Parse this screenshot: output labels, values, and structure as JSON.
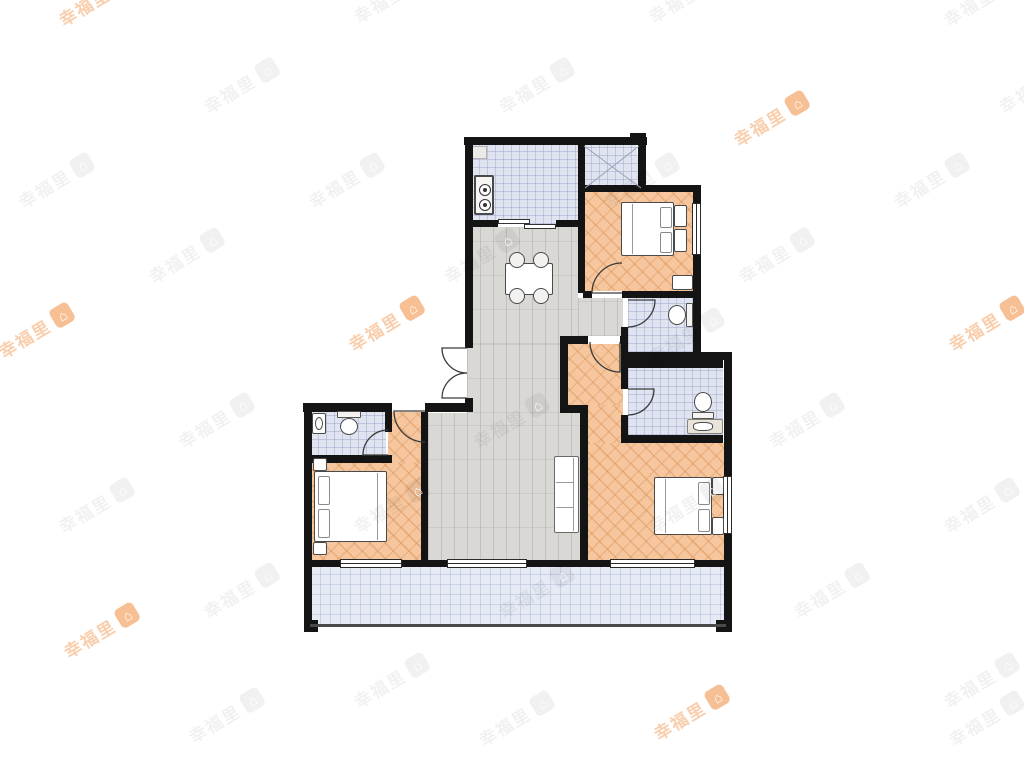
{
  "watermark": {
    "text": "幸福里",
    "logo_glyph": "⌂",
    "orange_color": "#f08a3c",
    "gray_color": "#000000",
    "positions": [
      {
        "x": 60,
        "y": 8,
        "c": "o"
      },
      {
        "x": 355,
        "y": 5,
        "c": "g"
      },
      {
        "x": 650,
        "y": 5,
        "c": "g"
      },
      {
        "x": 945,
        "y": 8,
        "c": "g"
      },
      {
        "x": 205,
        "y": 95,
        "c": "g"
      },
      {
        "x": 500,
        "y": 95,
        "c": "g"
      },
      {
        "x": 1000,
        "y": 95,
        "c": "g"
      },
      {
        "x": 735,
        "y": 128,
        "c": "o"
      },
      {
        "x": 20,
        "y": 190,
        "c": "g"
      },
      {
        "x": 310,
        "y": 190,
        "c": "g"
      },
      {
        "x": 605,
        "y": 190,
        "c": "g"
      },
      {
        "x": 895,
        "y": 190,
        "c": "g"
      },
      {
        "x": 150,
        "y": 265,
        "c": "g"
      },
      {
        "x": 445,
        "y": 265,
        "c": "g"
      },
      {
        "x": 740,
        "y": 265,
        "c": "g"
      },
      {
        "x": 0,
        "y": 340,
        "c": "o"
      },
      {
        "x": 350,
        "y": 333,
        "c": "o"
      },
      {
        "x": 650,
        "y": 345,
        "c": "g"
      },
      {
        "x": 950,
        "y": 333,
        "c": "o"
      },
      {
        "x": 180,
        "y": 430,
        "c": "g"
      },
      {
        "x": 475,
        "y": 430,
        "c": "g"
      },
      {
        "x": 770,
        "y": 430,
        "c": "g"
      },
      {
        "x": 60,
        "y": 515,
        "c": "g"
      },
      {
        "x": 355,
        "y": 515,
        "c": "g"
      },
      {
        "x": 650,
        "y": 515,
        "c": "g"
      },
      {
        "x": 945,
        "y": 515,
        "c": "g"
      },
      {
        "x": 205,
        "y": 600,
        "c": "g"
      },
      {
        "x": 500,
        "y": 600,
        "c": "g"
      },
      {
        "x": 795,
        "y": 600,
        "c": "g"
      },
      {
        "x": 65,
        "y": 640,
        "c": "o"
      },
      {
        "x": 355,
        "y": 690,
        "c": "g"
      },
      {
        "x": 945,
        "y": 690,
        "c": "g"
      },
      {
        "x": 190,
        "y": 725,
        "c": "g"
      },
      {
        "x": 480,
        "y": 728,
        "c": "g"
      },
      {
        "x": 655,
        "y": 722,
        "c": "o"
      },
      {
        "x": 950,
        "y": 728,
        "c": "g"
      }
    ]
  },
  "palette": {
    "wall": "#141414",
    "wood_floor": "#f6c79e",
    "gray_floor": "#d9d8d5",
    "tile_floor": "#e0e4f1",
    "balcony_floor": "#e5eaf5",
    "fixture_line": "#4a4a4a"
  },
  "floorplan": {
    "floors": [
      {
        "name": "kitchen-floor",
        "fill": "tile",
        "x": 471,
        "y": 144,
        "w": 108,
        "h": 80
      },
      {
        "name": "shaft-floor",
        "fill": "tile",
        "x": 583,
        "y": 144,
        "w": 60,
        "h": 44,
        "clip": "polygon(0 0,88% 0,100% 100%,0 100%)"
      },
      {
        "name": "bedroom-north-floor",
        "fill": "wood",
        "x": 583,
        "y": 190,
        "w": 110,
        "h": 101
      },
      {
        "name": "hall-nook-floor",
        "fill": "gray",
        "x": 578,
        "y": 298,
        "w": 45,
        "h": 38
      },
      {
        "name": "dining-floor",
        "fill": "gray",
        "x": 467,
        "y": 227,
        "w": 111,
        "h": 117
      },
      {
        "name": "dining-floor-lower",
        "fill": "gray",
        "x": 467,
        "y": 344,
        "w": 93,
        "h": 69
      },
      {
        "name": "living-floor",
        "fill": "gray",
        "x": 428,
        "y": 413,
        "w": 152,
        "h": 149
      },
      {
        "name": "master-corridor-floor",
        "fill": "wood",
        "x": 568,
        "y": 344,
        "w": 55,
        "h": 61
      },
      {
        "name": "master-corridor-floor-lower",
        "fill": "wood",
        "x": 588,
        "y": 405,
        "w": 35,
        "h": 38
      },
      {
        "name": "master-bedroom-floor",
        "fill": "wood",
        "x": 588,
        "y": 443,
        "w": 136,
        "h": 119
      },
      {
        "name": "bathroom-north-floor",
        "fill": "tile",
        "x": 628,
        "y": 298,
        "w": 65,
        "h": 54
      },
      {
        "name": "bathroom-master-floor",
        "fill": "tile",
        "x": 628,
        "y": 368,
        "w": 95,
        "h": 67
      },
      {
        "name": "bathroom-west-floor",
        "fill": "tile",
        "x": 310,
        "y": 412,
        "w": 76,
        "h": 44
      },
      {
        "name": "bedroom-west-floor",
        "fill": "wood",
        "x": 310,
        "y": 462,
        "w": 112,
        "h": 100
      },
      {
        "name": "bedroom-west-corridor-floor",
        "fill": "wood",
        "x": 388,
        "y": 412,
        "w": 34,
        "h": 51
      },
      {
        "name": "balcony-floor",
        "fill": "balcony",
        "x": 310,
        "y": 565,
        "w": 414,
        "h": 60
      },
      {
        "name": "kitchen-flue",
        "fill": "flue",
        "x": 472,
        "y": 146,
        "w": 15,
        "h": 13
      }
    ],
    "walls": [
      {
        "x": 464,
        "y": 137,
        "w": 183,
        "h": 8
      },
      {
        "x": 638,
        "y": 145,
        "w": 8,
        "h": 45
      },
      {
        "x": 630,
        "y": 133,
        "w": 16,
        "h": 12
      },
      {
        "x": 583,
        "y": 185,
        "w": 117,
        "h": 7
      },
      {
        "x": 693,
        "y": 185,
        "w": 8,
        "h": 178
      },
      {
        "x": 693,
        "y": 352,
        "w": 38,
        "h": 8
      },
      {
        "x": 724,
        "y": 352,
        "w": 8,
        "h": 280
      },
      {
        "x": 304,
        "y": 403,
        "w": 8,
        "h": 160
      },
      {
        "x": 304,
        "y": 562,
        "w": 8,
        "h": 70
      },
      {
        "x": 303,
        "y": 403,
        "w": 89,
        "h": 9
      },
      {
        "x": 425,
        "y": 403,
        "w": 48,
        "h": 9
      },
      {
        "x": 465,
        "y": 137,
        "w": 8,
        "h": 211
      },
      {
        "x": 465,
        "y": 398,
        "w": 8,
        "h": 14
      },
      {
        "x": 465,
        "y": 220,
        "w": 33,
        "h": 7
      },
      {
        "x": 556,
        "y": 220,
        "w": 27,
        "h": 7
      },
      {
        "x": 578,
        "y": 141,
        "w": 7,
        "h": 49
      },
      {
        "x": 578,
        "y": 190,
        "w": 7,
        "h": 103
      },
      {
        "x": 583,
        "y": 291,
        "w": 9,
        "h": 7
      },
      {
        "x": 622,
        "y": 291,
        "w": 78,
        "h": 7
      },
      {
        "x": 621,
        "y": 327,
        "w": 7,
        "h": 25
      },
      {
        "x": 621,
        "y": 352,
        "w": 79,
        "h": 8
      },
      {
        "x": 621,
        "y": 360,
        "w": 102,
        "h": 8
      },
      {
        "x": 621,
        "y": 368,
        "w": 7,
        "h": 21
      },
      {
        "x": 621,
        "y": 415,
        "w": 7,
        "h": 22
      },
      {
        "x": 621,
        "y": 435,
        "w": 102,
        "h": 8
      },
      {
        "x": 560,
        "y": 336,
        "w": 28,
        "h": 8
      },
      {
        "x": 620,
        "y": 336,
        "w": 8,
        "h": 8
      },
      {
        "x": 560,
        "y": 336,
        "w": 8,
        "h": 77
      },
      {
        "x": 560,
        "y": 405,
        "w": 28,
        "h": 8
      },
      {
        "x": 580,
        "y": 413,
        "w": 8,
        "h": 149
      },
      {
        "x": 385,
        "y": 412,
        "w": 7,
        "h": 20
      },
      {
        "x": 310,
        "y": 455,
        "w": 82,
        "h": 8
      },
      {
        "x": 421,
        "y": 412,
        "w": 7,
        "h": 150
      },
      {
        "x": 304,
        "y": 560,
        "w": 36,
        "h": 7
      },
      {
        "x": 402,
        "y": 560,
        "w": 45,
        "h": 7
      },
      {
        "x": 527,
        "y": 560,
        "w": 83,
        "h": 7
      },
      {
        "x": 695,
        "y": 560,
        "w": 36,
        "h": 7
      },
      {
        "x": 304,
        "y": 620,
        "w": 14,
        "h": 12
      },
      {
        "x": 716,
        "y": 620,
        "w": 14,
        "h": 12
      }
    ],
    "rails": [
      {
        "x": 310,
        "y": 624,
        "w": 416,
        "h": 3
      }
    ],
    "windows": [
      {
        "name": "bedroom-north-window",
        "x": 692,
        "y": 203,
        "w": 9,
        "h": 52,
        "o": "v"
      },
      {
        "name": "master-bedroom-window",
        "x": 723,
        "y": 476,
        "w": 9,
        "h": 58,
        "o": "v"
      },
      {
        "name": "balcony-window-west",
        "x": 340,
        "y": 559,
        "w": 62,
        "h": 9,
        "o": "h"
      },
      {
        "name": "balcony-door-living",
        "x": 447,
        "y": 559,
        "w": 80,
        "h": 9,
        "o": "h"
      },
      {
        "name": "balcony-window-master",
        "x": 610,
        "y": 559,
        "w": 85,
        "h": 9,
        "o": "h"
      }
    ],
    "sliders": [
      {
        "name": "kitchen-sliding-door",
        "slats": [
          {
            "x": 498,
            "y": 219,
            "w": 32,
            "h": 5
          },
          {
            "x": 524,
            "y": 224,
            "w": 32,
            "h": 5
          }
        ]
      }
    ],
    "doors": [
      {
        "name": "entry-door-leaf-upper",
        "d": "M467,348 L442,348 A25,25 0 0 0 467,373"
      },
      {
        "name": "entry-door-leaf-lower",
        "d": "M467,398 L442,398 A25,25 0 0 1 467,373"
      },
      {
        "name": "bedroom-north-door",
        "d": "M622,293 L592,293 A30,30 0 0 1 622,263"
      },
      {
        "name": "bathroom-north-door",
        "d": "M628,300 L655,300 A27,27 0 0 1 628,327"
      },
      {
        "name": "master-bedroom-door",
        "d": "M620,342 L620,372 A30,30 0 0 1 590,342"
      },
      {
        "name": "bathroom-master-door",
        "d": "M628,389 L654,389 A26,26 0 0 1 628,415"
      },
      {
        "name": "bedroom-west-door",
        "d": "M425,411 L394,411 A31,31 0 0 0 425,442"
      },
      {
        "name": "bathroom-west-door",
        "d": "M388,455 L363,455 A25,25 0 0 1 388,430"
      }
    ],
    "shaft_cross": "M584,146 L641,188 M639,146 L585,188",
    "furniture": [
      {
        "type": "stove",
        "name": "kitchen-stove",
        "x": 474,
        "y": 175,
        "w": 20,
        "h": 40
      },
      {
        "type": "table",
        "name": "dining-table",
        "x": 505,
        "y": 263,
        "w": 48,
        "h": 32
      },
      {
        "type": "chair",
        "name": "dining-chair",
        "cx": 517,
        "cy": 260,
        "r": 8
      },
      {
        "type": "chair",
        "name": "dining-chair",
        "cx": 541,
        "cy": 260,
        "r": 8
      },
      {
        "type": "chair",
        "name": "dining-chair",
        "cx": 517,
        "cy": 296,
        "r": 8
      },
      {
        "type": "chair",
        "name": "dining-chair",
        "cx": 541,
        "cy": 296,
        "r": 8
      },
      {
        "type": "setting",
        "name": "place-setting",
        "x": 510,
        "y": 268
      },
      {
        "type": "setting",
        "name": "place-setting",
        "x": 534,
        "y": 268
      },
      {
        "type": "setting",
        "name": "place-setting",
        "x": 510,
        "y": 282
      },
      {
        "type": "setting",
        "name": "place-setting",
        "x": 534,
        "y": 282
      },
      {
        "type": "sofa",
        "name": "living-sofa",
        "x": 554,
        "y": 456,
        "w": 25,
        "h": 77
      },
      {
        "type": "bed",
        "name": "bed-north",
        "x": 621,
        "y": 202,
        "w": 53,
        "h": 54,
        "head": "e"
      },
      {
        "type": "box",
        "name": "nightstand",
        "x": 674,
        "y": 205,
        "w": 13,
        "h": 22
      },
      {
        "type": "box",
        "name": "nightstand",
        "x": 674,
        "y": 229,
        "w": 13,
        "h": 23
      },
      {
        "type": "box",
        "name": "cabinet",
        "x": 672,
        "y": 275,
        "w": 21,
        "h": 15
      },
      {
        "type": "bed",
        "name": "bed-west",
        "x": 314,
        "y": 471,
        "w": 73,
        "h": 71,
        "head": "w"
      },
      {
        "type": "box",
        "name": "nightstand",
        "x": 313,
        "y": 458,
        "w": 14,
        "h": 13
      },
      {
        "type": "box",
        "name": "nightstand",
        "x": 313,
        "y": 542,
        "w": 14,
        "h": 13
      },
      {
        "type": "bed",
        "name": "bed-master",
        "x": 654,
        "y": 477,
        "w": 58,
        "h": 58,
        "head": "e"
      },
      {
        "type": "box",
        "name": "nightstand",
        "x": 712,
        "y": 477,
        "w": 12,
        "h": 18
      },
      {
        "type": "box",
        "name": "nightstand",
        "x": 712,
        "y": 517,
        "w": 12,
        "h": 18
      },
      {
        "type": "toilet",
        "name": "toilet-west",
        "x": 337,
        "y": 411,
        "w": 24,
        "h": 24,
        "tank": "n"
      },
      {
        "type": "toilet",
        "name": "toilet-north",
        "x": 668,
        "y": 303,
        "w": 25,
        "h": 24,
        "tank": "e"
      },
      {
        "type": "toilet",
        "name": "toilet-master",
        "x": 692,
        "y": 392,
        "w": 22,
        "h": 27,
        "tank": "s"
      },
      {
        "type": "basin",
        "name": "washbasin-west",
        "x": 312,
        "y": 413,
        "w": 14,
        "h": 21
      },
      {
        "type": "counter",
        "name": "vanity-counter",
        "x": 687,
        "y": 419,
        "w": 36,
        "h": 15
      }
    ]
  }
}
